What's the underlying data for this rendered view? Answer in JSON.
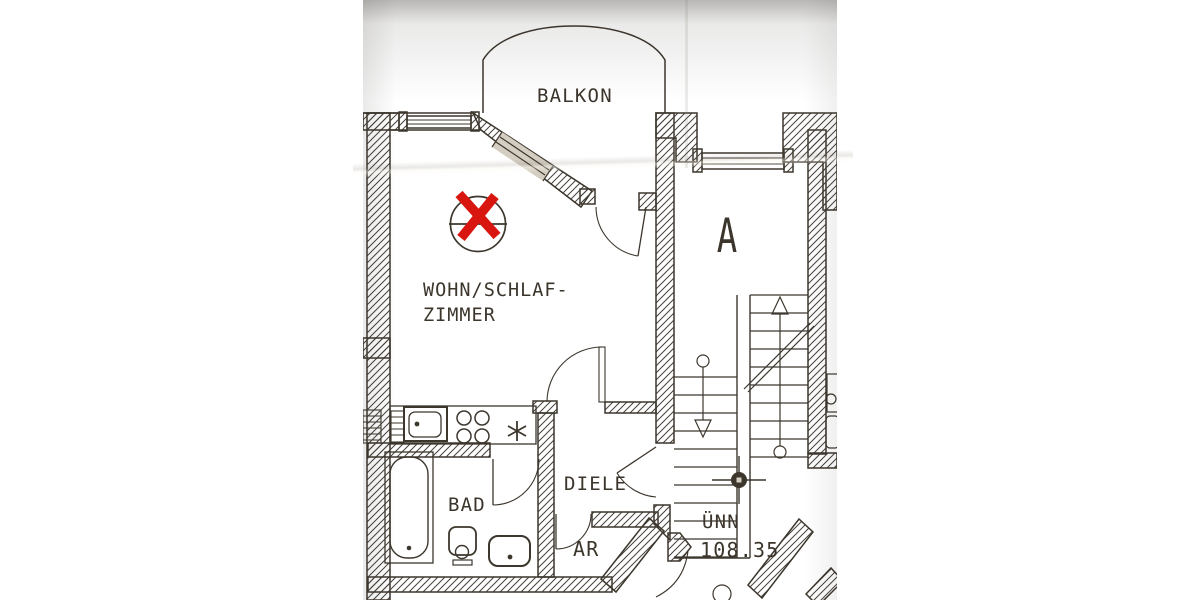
{
  "photo": {
    "description": "photograph of an architectural floor plan, letterboxed with white side bars",
    "colors": {
      "paper": "#d6d0c4",
      "ink": "#3c362d",
      "marker_red": "#d9150f",
      "letterbox": "#ffffff"
    },
    "rooms": {
      "balcony_label": "BALKON",
      "living_label_line1": "WOHN/SCHLAF-",
      "living_label_line2": "ZIMMER",
      "bath_label": "BAD",
      "hall_label": "DIELE",
      "storage_label": "AR"
    },
    "staircase": {
      "marker": "A"
    },
    "level": {
      "name": "ÜNN",
      "value": "108.35"
    },
    "annotation": {
      "symbol": "X"
    }
  }
}
